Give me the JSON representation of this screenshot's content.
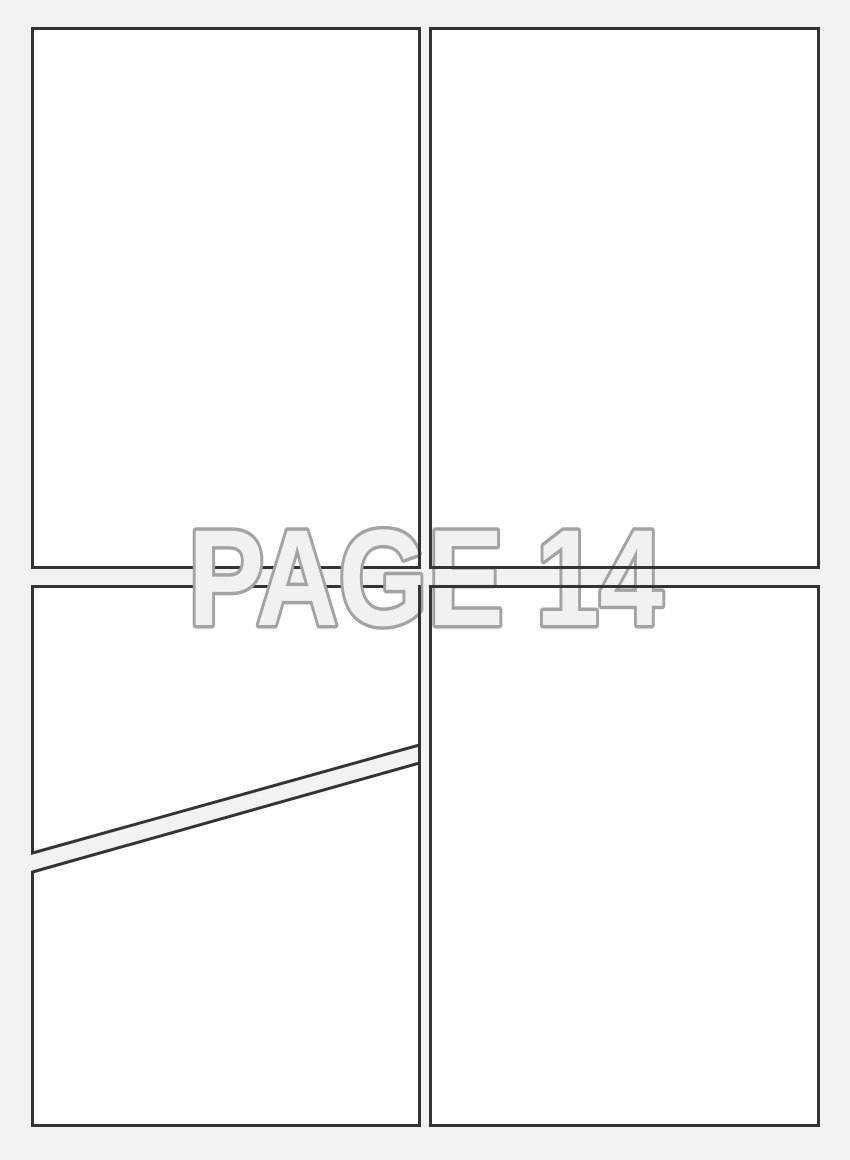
{
  "page": {
    "label": "PAGE 14"
  },
  "colors": {
    "background": "#f2f2f2",
    "panel_fill": "#ffffff",
    "panel_border": "#333333",
    "label_fill": "#f1f1f1",
    "label_outline": "#a3a3a3"
  },
  "panels": [
    {
      "id": "panel-top-left"
    },
    {
      "id": "panel-top-right"
    },
    {
      "id": "panel-bottom-left-upper"
    },
    {
      "id": "panel-bottom-left-lower"
    },
    {
      "id": "panel-bottom-right"
    }
  ]
}
